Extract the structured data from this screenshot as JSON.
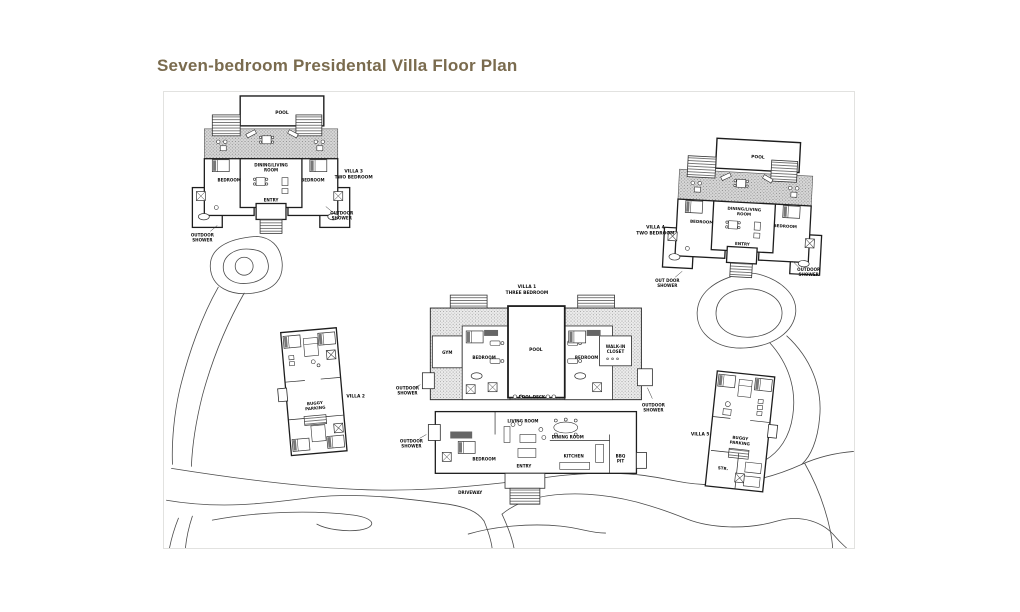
{
  "page": {
    "title": "Seven-bedroom Presidental Villa Floor Plan"
  },
  "terms": {
    "pool": "POOL",
    "pool_deck": "POOL DECK",
    "bedroom": "BEDROOM",
    "entry": "ENTRY",
    "gym": "GYM",
    "kitchen": "KITCHEN",
    "living_room": "LIVING ROOM",
    "dining_room": "DINING ROOM",
    "driveway": "DRIVEWAY",
    "str": "STR.",
    "outdoor_shower": [
      "OUTDOOR",
      "SHOWER"
    ],
    "out_door_shower": [
      "OUT DOOR",
      "SHOWER"
    ],
    "buggy_parking": [
      "BUGGY",
      "PARKING"
    ],
    "dining_living_room": [
      "DINING/LIVING",
      "ROOM"
    ],
    "walk_in_closet": [
      "WALK-IN",
      "CLOSET"
    ],
    "bbq_pit": [
      "BBQ",
      "PIT"
    ]
  },
  "villas": {
    "villa1": {
      "name": "VILLA 1",
      "type": "THREE BEDROOM"
    },
    "villa2": {
      "name": "VILLA 2"
    },
    "villa3": {
      "name": "VILLA 3",
      "type": "TWO BEDROOM"
    },
    "villa4": {
      "name": "VILLA 4",
      "type": "TWO BEDROOM"
    },
    "villa5": {
      "name": "VILLA 5"
    }
  }
}
